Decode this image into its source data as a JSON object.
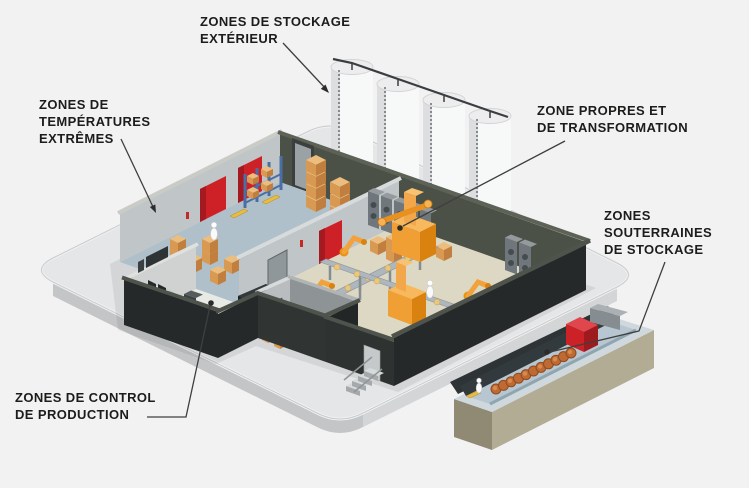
{
  "callouts": [
    {
      "id": "exterior-storage",
      "lines": [
        "ZONES DE STOCKAGE",
        "EXTÉRIEUR"
      ],
      "target": "outdoor-silos"
    },
    {
      "id": "extreme-temperatures",
      "lines": [
        "ZONES DE",
        "TEMPÉRATURES",
        "EXTRÊMES"
      ],
      "target": "cold-storage-room"
    },
    {
      "id": "clean-transformation",
      "lines": [
        "ZONE PROPRES ET",
        "DE TRANSFORMATION"
      ],
      "target": "production-hall"
    },
    {
      "id": "underground-storage",
      "lines": [
        "ZONES",
        "SOUTERRAINES",
        "DE STOCKAGE"
      ],
      "target": "underground-storage-trench"
    },
    {
      "id": "production-control",
      "lines": [
        "ZONES DE CONTROL",
        "DE PRODUCTION"
      ],
      "target": "control-room"
    }
  ],
  "palette": {
    "background": "#f2f2f3",
    "platform_top": "#e5e6e7",
    "platform_side_left": "#c3c5c7",
    "platform_side_right": "#d3d5d6",
    "wall_dark": "#26292a",
    "wall_olive": "#4c5147",
    "wall_cap_olive": "#4e534c",
    "wall_light": "#c0c5c7",
    "wall_cap_light": "#d8dbdb",
    "cold_floor": "#afc0cb",
    "production_floor": "#dcd8c3",
    "control_floor": "#e8ebe5",
    "storage_floor": "#c4c9c3",
    "door_red": "#ce2127",
    "door_blue": "#4a549e",
    "box_orange": "#ecbd7c",
    "machine_orange": "#ef9f33",
    "conveyor_gray": "#aeb7bd",
    "cabinet_gray": "#70777c",
    "silo_white": "#f7f8f8",
    "trench_khaki": "#b3ac95",
    "trench_floor": "#b7c6d0",
    "barrel_orange": "#bf6a33",
    "cube_red": "#cb2127",
    "rack_blue": "#4a6fa5",
    "leader_line": "#3f3f3f",
    "text_color": "#1c1c1a"
  },
  "scene": {
    "silo_count": 4,
    "elements": [
      "outdoor-silos",
      "cold-storage-room",
      "production-hall",
      "control-room",
      "storage-rooms",
      "underground-storage-trench",
      "stairs",
      "workers",
      "conveyors",
      "robots",
      "pallet-boxes",
      "barrels",
      "roll-up-doors"
    ]
  }
}
